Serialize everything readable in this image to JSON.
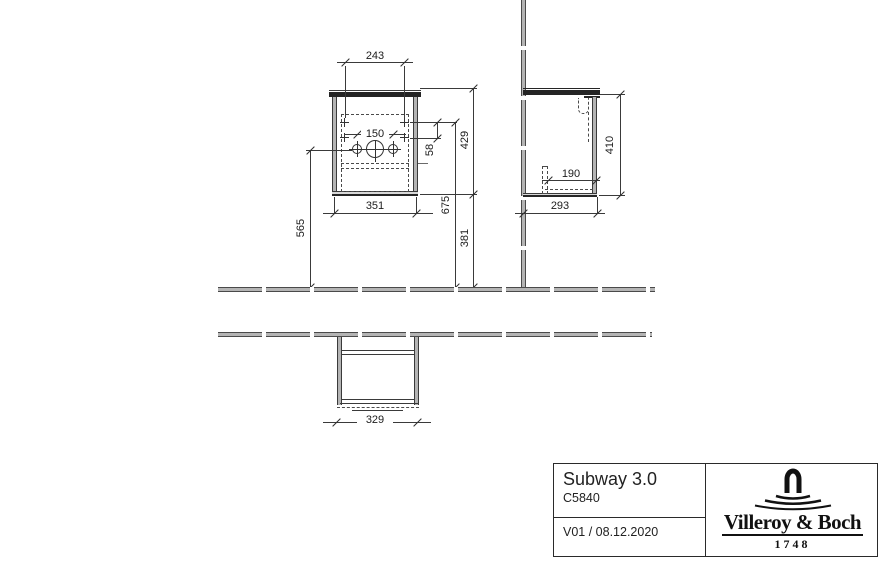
{
  "dims": {
    "front": {
      "drill_width": "243",
      "tap_spacing": "150",
      "hinge_gap": "58",
      "height": "429",
      "width": "351",
      "drill_row_height": "675",
      "under_clearance": "381",
      "outlet_height": "565"
    },
    "side": {
      "depth": "293",
      "outlet_depth": "190",
      "height": "410"
    },
    "plan": {
      "carcass_width": "329"
    }
  },
  "title_block": {
    "product_name": "Subway 3.0",
    "product_code": "C5840",
    "version_date": "V01 / 08.12.2020",
    "brand": "Villeroy & Boch",
    "brand_year": "1748"
  },
  "colors": {
    "line": "#3a3a3a",
    "dark_fill": "#242424",
    "gray_fill": "#b4b4b4",
    "background": "#ffffff"
  },
  "icons": {
    "logo": "villeroy-boch-fountain-icon"
  }
}
